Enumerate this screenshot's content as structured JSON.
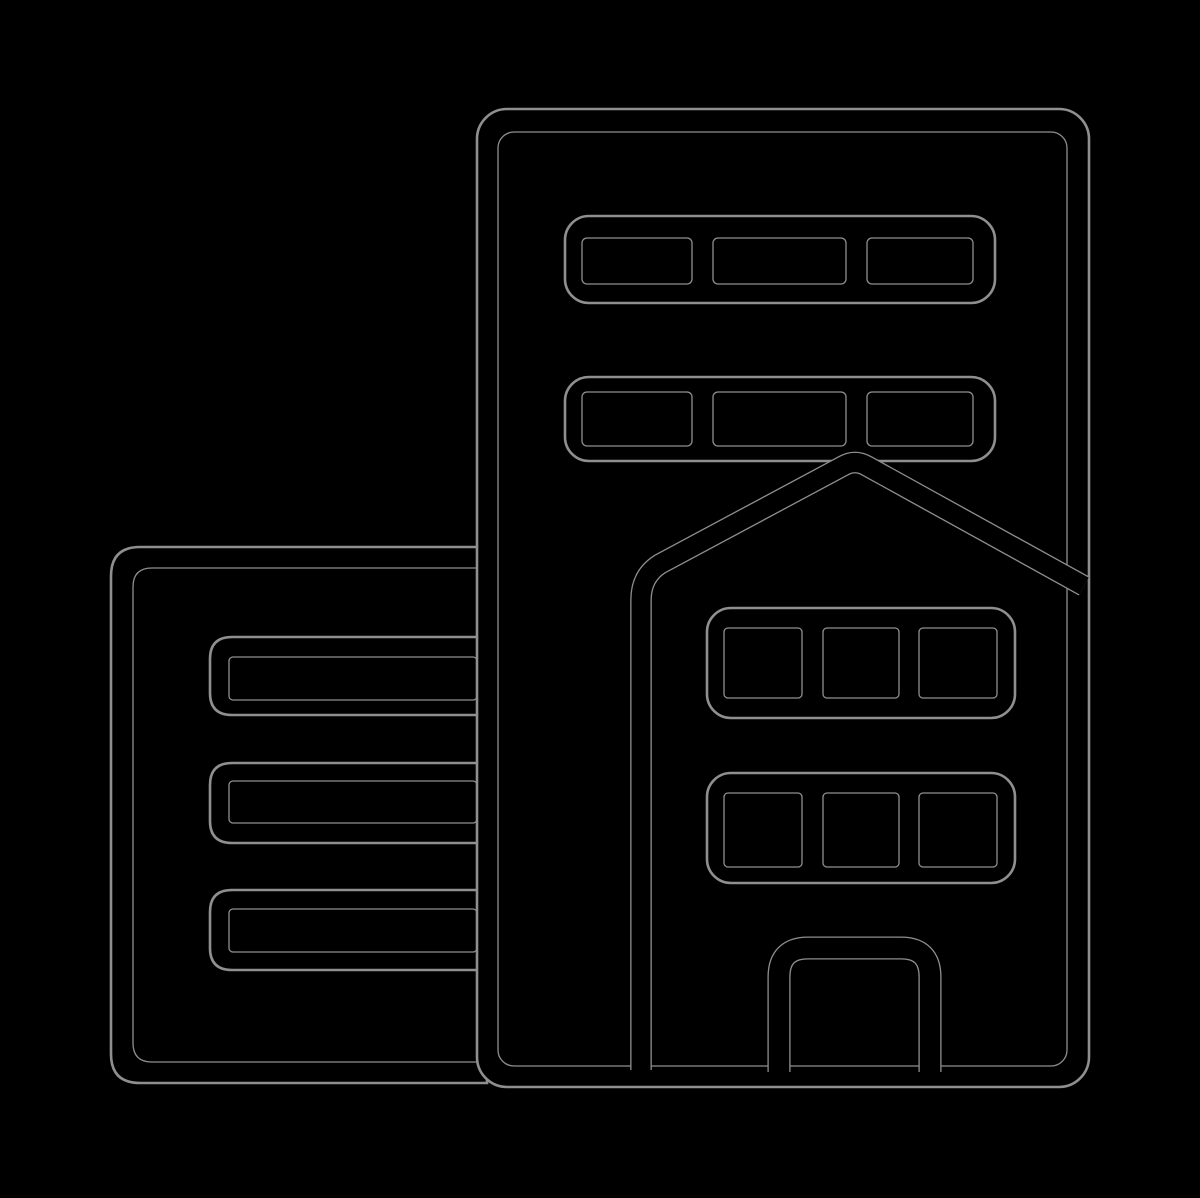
{
  "scene": {
    "background_color": "#000000",
    "outline_color": "#8f8f8f",
    "ink_color": "#000000",
    "width_px": 1200,
    "height_px": 1198
  },
  "icon": {
    "name": "city-buildings-icon",
    "title": "City buildings icon",
    "description": "Black line-art glyph of city buildings on a black background, visible only as faint gray outline edges: a tall office tower with two bands of three windows, a pitched-roof house in front with two rows of three windows and a central door, and a low annex building on the left with three horizontal window bars."
  }
}
